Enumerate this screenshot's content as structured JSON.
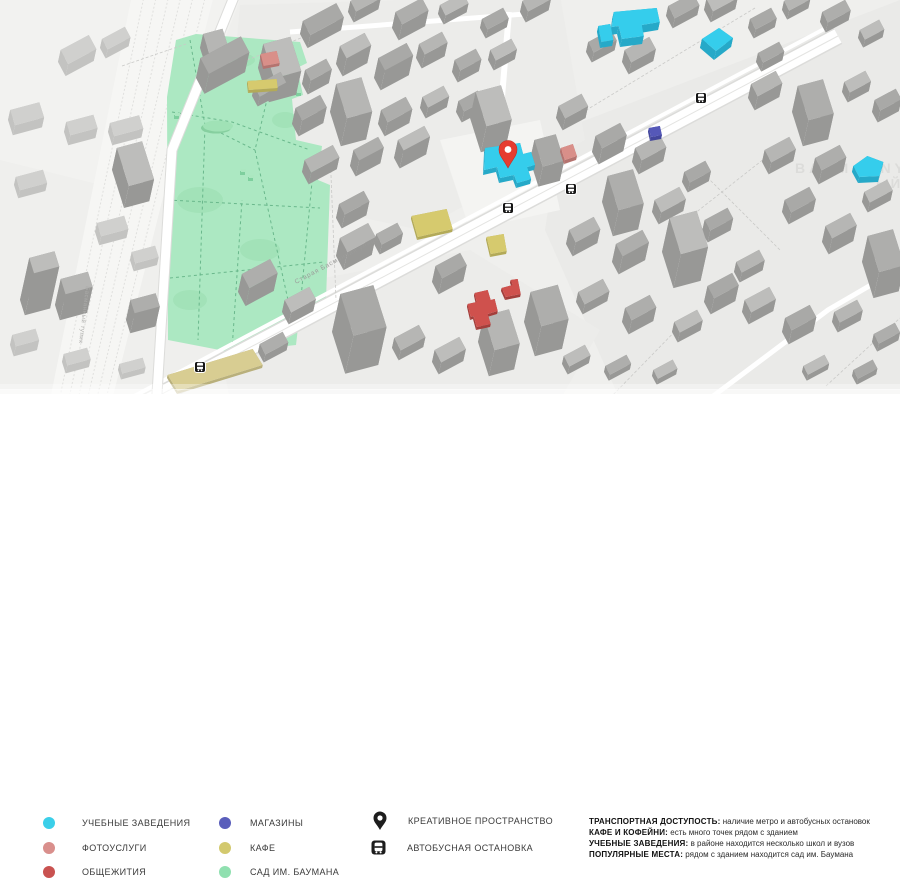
{
  "legend": {
    "items": [
      {
        "label": "УЧЕБНЫЕ ЗАВЕДЕНИЯ",
        "color": "#3bcfe9",
        "key": "education"
      },
      {
        "label": "ФОТОУСЛУГИ",
        "color": "#d98f8c",
        "key": "photo"
      },
      {
        "label": "ОБЩЕЖИТИЯ",
        "color": "#c95250",
        "key": "dorm"
      },
      {
        "label": "МАГАЗИНЫ",
        "color": "#5a5ebb",
        "key": "shops"
      },
      {
        "label": "КАФЕ",
        "color": "#d3c96e",
        "key": "cafe"
      },
      {
        "label": "САД ИМ. БАУМАНА",
        "color": "#90e0b0",
        "key": "garden"
      }
    ],
    "marker_items": [
      {
        "label": "КРЕАТИВНОЕ ПРОСТРАНСТВО",
        "icon": "location-pin"
      },
      {
        "label": "АВТОБУСНАЯ ОСТАНОВКА",
        "icon": "bus-stop"
      }
    ]
  },
  "info": {
    "lines": [
      {
        "title": "ТРАНСПОРТНАЯ ДОСТУПОСТЬ:",
        "text": " наличие метро и автобусных остановок"
      },
      {
        "title": "КАФЕ И КОФЕЙНИ:",
        "text": " есть много точек рядом с зданием"
      },
      {
        "title": "УЧЕБНЫЕ ЗАВЕДЕНИЯ:",
        "text": " в районе находится несколько школ и вузов"
      },
      {
        "title": "ПОПУЛЯРНЫЕ МЕСТА:",
        "text": " рядом с зданием находится сад им. Баумана"
      }
    ]
  },
  "map": {
    "street_labels": [
      {
        "text": "Старая Басманная улица"
      },
      {
        "text": "Басманный тупик"
      },
      {
        "text": "BASMANNY"
      },
      {
        "text": "ЫЙ"
      }
    ],
    "palette": {
      "education": "#35cdec",
      "photo": "#d98f89",
      "dorm": "#cf514d",
      "shops": "#5558b8",
      "cafe": "#d6ca6e",
      "tan": "#d8cd92",
      "park_fill": "#ace8c2",
      "pin": "#e63c30",
      "bus": "#151515"
    }
  }
}
